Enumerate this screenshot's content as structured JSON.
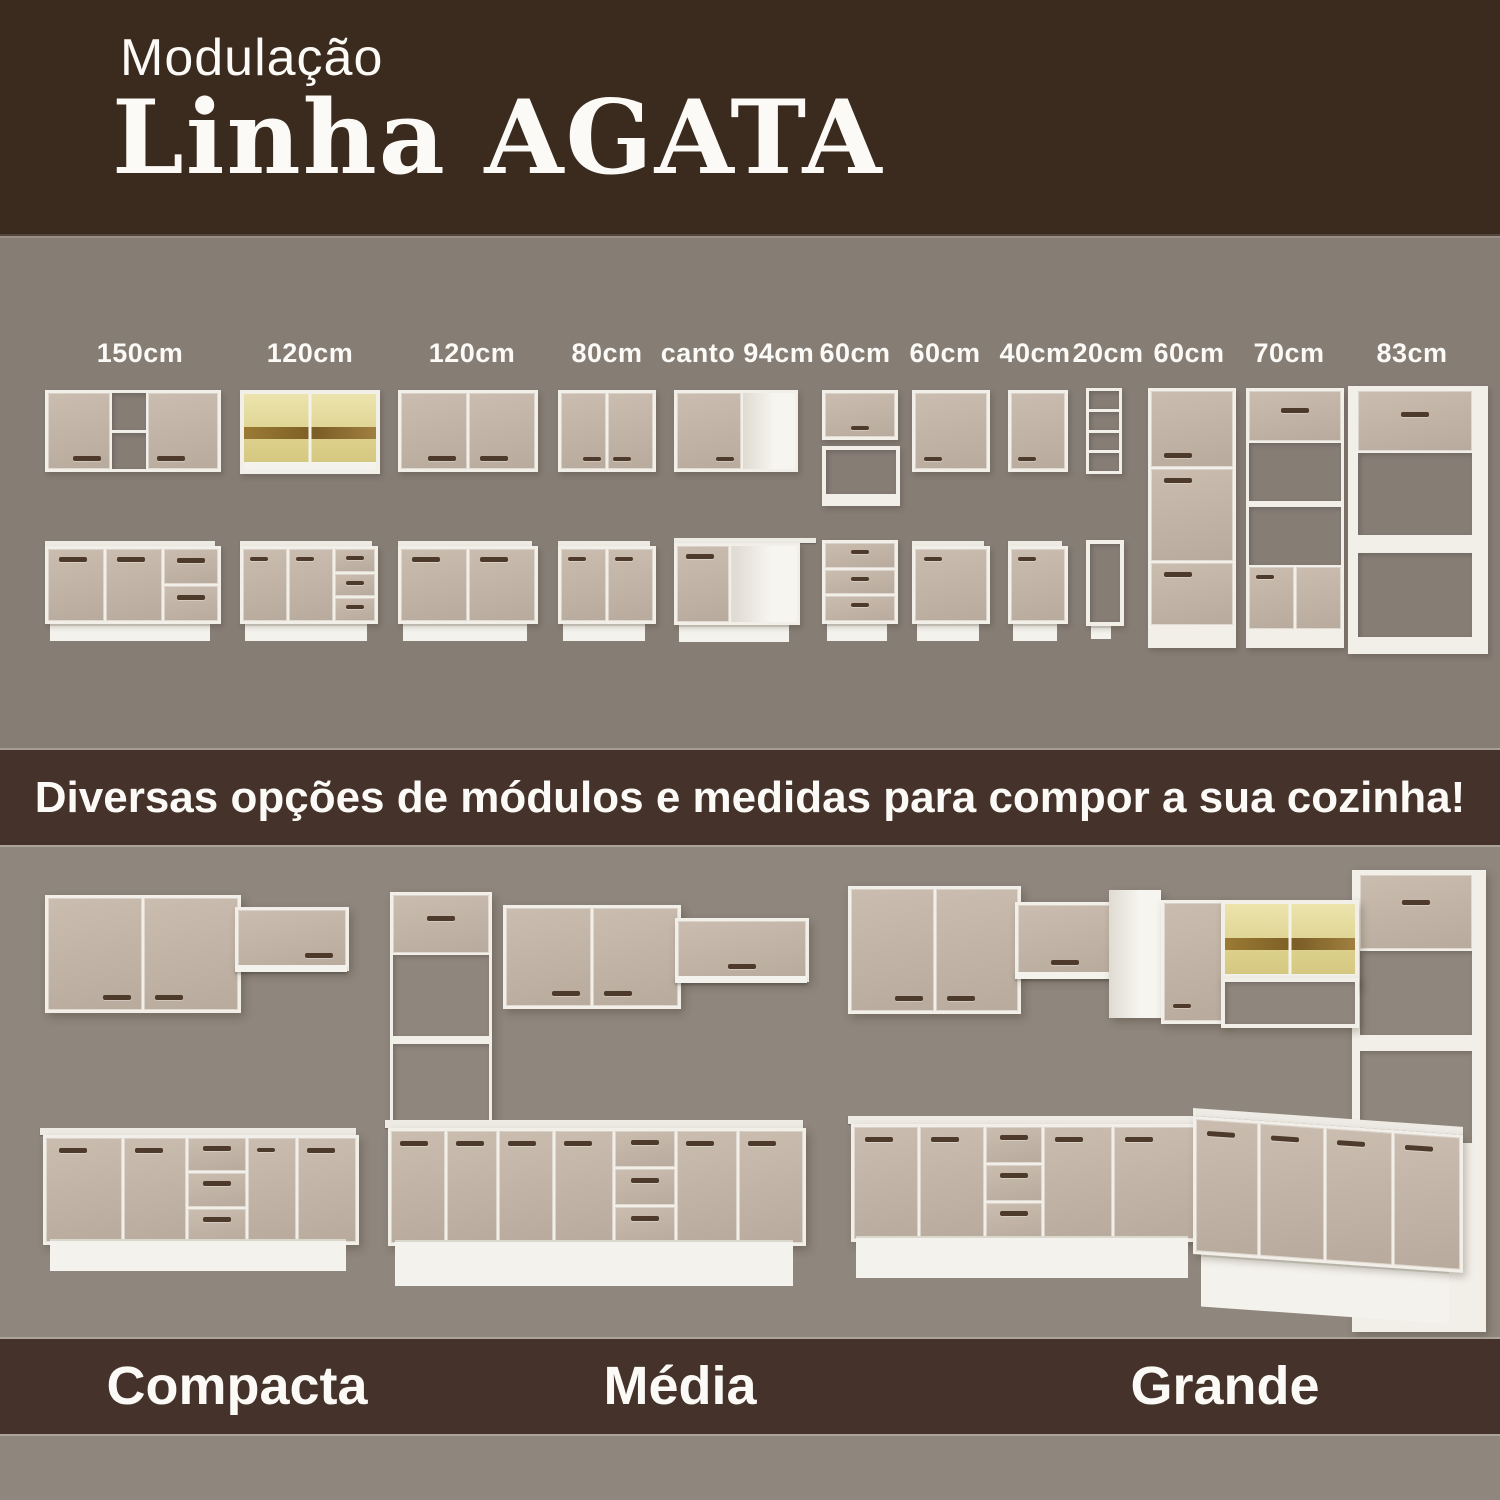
{
  "header": {
    "line1": "Modulação",
    "line2": "Linha AGATA"
  },
  "modules": {
    "labels": [
      "150cm",
      "120cm",
      "120cm",
      "80cm",
      "canto 94cm",
      "60cm",
      "60cm",
      "40cm",
      "20cm",
      "60cm",
      "70cm",
      "83cm"
    ]
  },
  "banner": {
    "text": "Diversas opções de módulos e medidas para compor a sua cozinha!"
  },
  "kitchens": {
    "labels": [
      "Compacta",
      "Média",
      "Grande"
    ]
  },
  "colors": {
    "band_brown": "#3b2a1e",
    "band_brown2": "#45322a",
    "bg_upper": "#867d75",
    "bg_lower": "#8f867d",
    "frame_white": "#f2efe8",
    "door_beige": "#c1b4a6",
    "handle_brown": "#4e3a2b",
    "glass_yellow": "#ddd28e",
    "glass_wood": "#8a6a3c",
    "text_white": "#fbfaf6"
  }
}
